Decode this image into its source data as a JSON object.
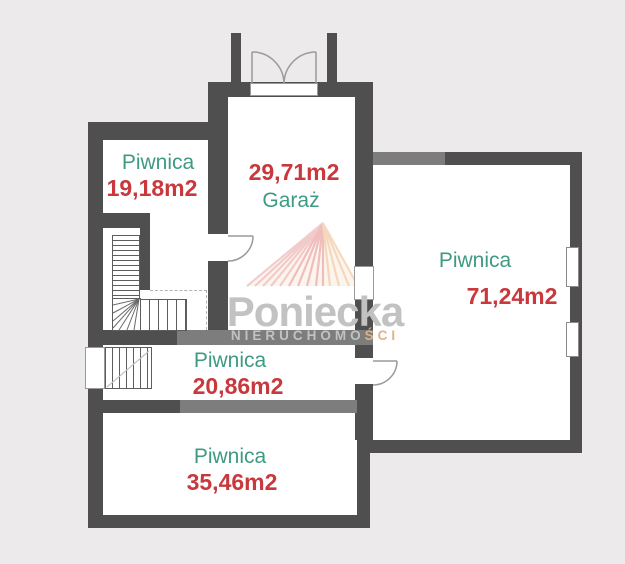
{
  "colors": {
    "background": "#ECEAEA",
    "wall_dark": "#4F4F4F",
    "wall_medium": "#7D7D7D",
    "room_fill": "#FFFFFF",
    "room_name_teal": "#3E9A82",
    "room_area_red": "#C9383C",
    "door_stroke": "#9A9A9A",
    "watermark_gray": "#C2C2C2",
    "watermark_accent": "#E0B287",
    "logo_pink": "#EAA7AF",
    "logo_salmon": "#E79096",
    "logo_orange": "#F0C096"
  },
  "rooms": [
    {
      "id": "cellar-top-left",
      "name": "Piwnica",
      "area": "19,18m2"
    },
    {
      "id": "garage",
      "name": "Garaż",
      "area": "29,71m2"
    },
    {
      "id": "cellar-right",
      "name": "Piwnica",
      "area": "71,24m2"
    },
    {
      "id": "cellar-middle",
      "name": "Piwnica",
      "area": "20,86m2"
    },
    {
      "id": "cellar-bottom",
      "name": "Piwnica",
      "area": "35,46m2"
    }
  ],
  "watermark": {
    "brand": "Poniecka",
    "tagline_main": "NIERUCHOMO",
    "tagline_accent": "ŚCI"
  }
}
